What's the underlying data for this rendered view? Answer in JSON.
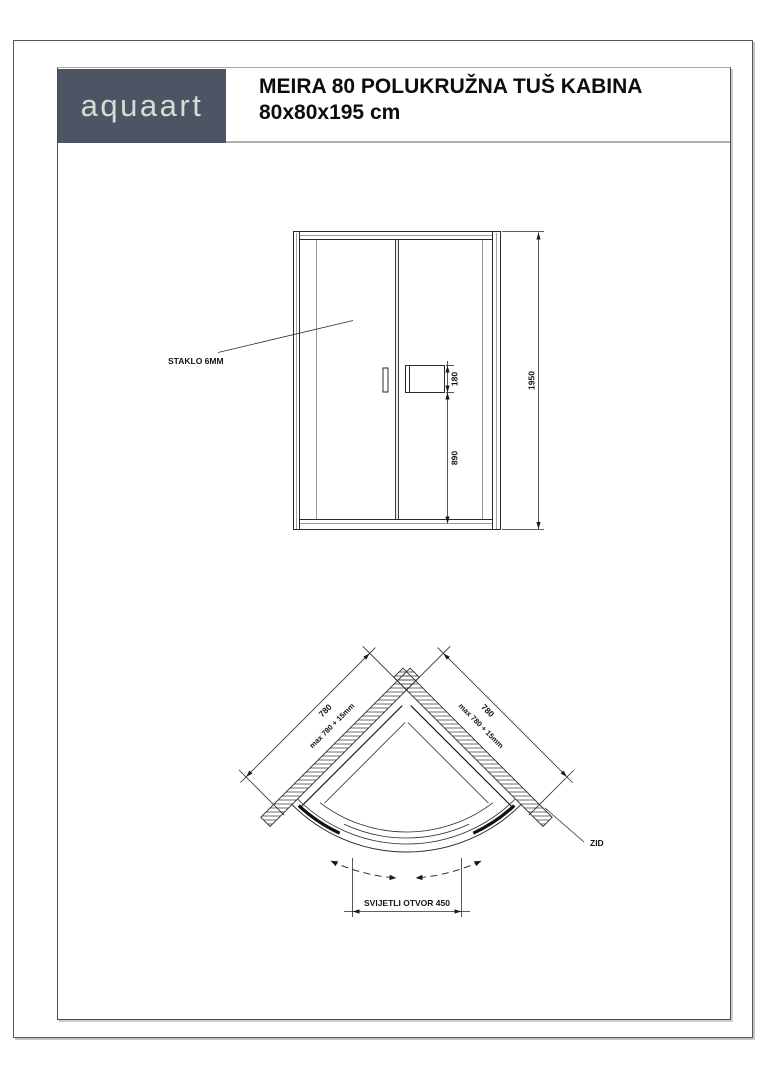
{
  "header": {
    "logo": "aquaart",
    "title_line1": "MEIRA 80 POLUKRUŽNA TUŠ KABINA",
    "title_line2": "80x80x195 cm"
  },
  "colors": {
    "logo_bg": "#4d5565",
    "logo_fg": "#cfe0d3",
    "line": "#2b2b2b"
  },
  "front_view": {
    "glass_label": "STAKLO 6MM",
    "dim_total_height": "1950",
    "dim_lower_height": "890",
    "dim_bracket": "180"
  },
  "top_view": {
    "dim_left_wall": "780",
    "dim_left_wall_max": "max 780 + 15mm",
    "dim_right_wall": "780",
    "dim_right_wall_max": "max 780 + 15mm",
    "wall_label": "ZID",
    "opening_label": "SVIJETLI OTVOR 450"
  }
}
